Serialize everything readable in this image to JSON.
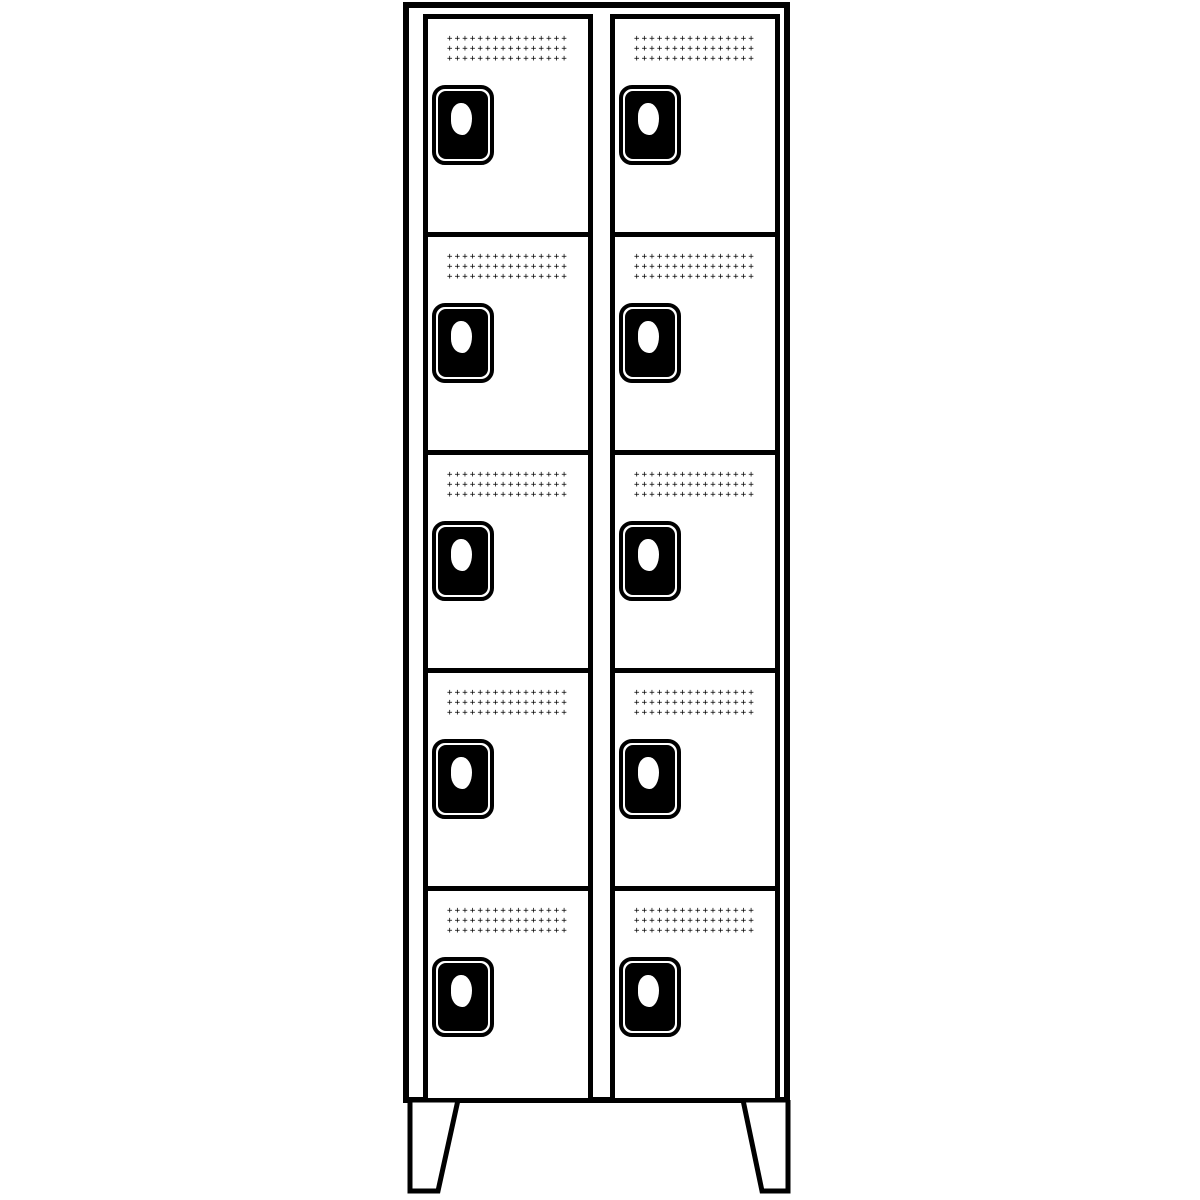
{
  "scene": {
    "description": "Black-and-white line drawing of a cloakroom locker cabinet",
    "background_color": "#ffffff",
    "outline_color": "#000000"
  },
  "cabinet": {
    "columns": 2,
    "rows_per_column": 5,
    "total_compartments": 10,
    "has_feet": true
  },
  "door": {
    "lock_plate_color": "#000000",
    "keyhole_color": "#ffffff"
  },
  "vent": {
    "rows_per_grille": 3,
    "row_pattern": "++++++++++++++++"
  }
}
